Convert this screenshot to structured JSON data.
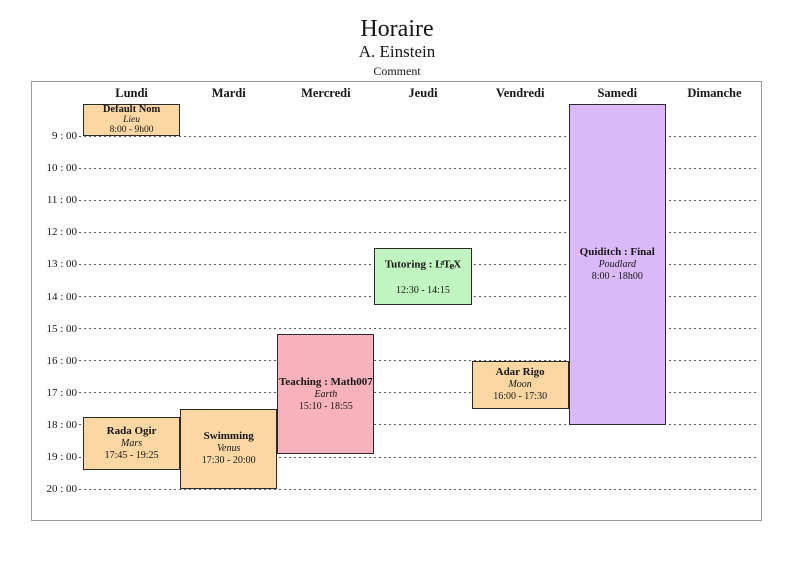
{
  "page": {
    "title": "Horaire",
    "author": "A. Einstein",
    "comment": "Comment"
  },
  "schedule": {
    "days": [
      "Lundi",
      "Mardi",
      "Mercredi",
      "Jeudi",
      "Vendredi",
      "Samedi",
      "Dimanche"
    ],
    "hour_labels": [
      "9 : 00",
      "10 : 00",
      "11 : 00",
      "12 : 00",
      "13 : 00",
      "14 : 00",
      "15 : 00",
      "16 : 00",
      "17 : 00",
      "18 : 00",
      "19 : 00",
      "20 : 00"
    ],
    "first_hour": 9,
    "last_hour": 20
  },
  "events": [
    {
      "title": "Default Nom",
      "location": "Lieu",
      "time": "8:00 - 9h00",
      "day": "Lundi",
      "day_index": 0,
      "start_hour": 8,
      "end_hour": 9,
      "color": "#fbd7a4"
    },
    {
      "title": "Rada Ogir",
      "location": "Mars",
      "time": "17:45 - 19:25",
      "day": "Lundi",
      "day_index": 0,
      "start_hour": 17.75,
      "end_hour": 19.42,
      "color": "#fbd7a4"
    },
    {
      "title": "Swimming",
      "location": "Venus",
      "time": "17:30 - 20:00",
      "day": "Mardi",
      "day_index": 1,
      "start_hour": 17.5,
      "end_hour": 20,
      "color": "#fbd7a4"
    },
    {
      "title": "Teaching : Math007",
      "location": "Earth",
      "time": "15:10 - 18:55",
      "day": "Mercredi",
      "day_index": 2,
      "start_hour": 15.17,
      "end_hour": 18.92,
      "color": "#f8b2bc"
    },
    {
      "title": "Tutoring : LaTeX",
      "latex_logo": true,
      "location": "",
      "time": "12:30 - 14:15",
      "day": "Jeudi",
      "day_index": 3,
      "start_hour": 12.5,
      "end_hour": 14.25,
      "color": "#c0f5c1"
    },
    {
      "title": "Adar Rigo",
      "location": "Moon",
      "time": "16:00 - 17:30",
      "day": "Vendredi",
      "day_index": 4,
      "start_hour": 16,
      "end_hour": 17.5,
      "color": "#fbd7a4"
    },
    {
      "title": "Quiditch : Final",
      "location": "Poudlard",
      "time": "8:00 - 18h00",
      "day": "Samedi",
      "day_index": 5,
      "start_hour": 8,
      "end_hour": 18,
      "color": "#dbb8f7"
    }
  ],
  "colors": {
    "frame_border": "#9a9a9a",
    "grid_dashes": "#5a5a5a",
    "event_border": "#2a2a2a",
    "event_peach": "#fbd7a4",
    "event_pink": "#f8b2bc",
    "event_green": "#c0f5c1",
    "event_purple": "#dbb8f7"
  },
  "chart_data": {
    "type": "table",
    "title": "Horaire",
    "subtitle": "A. Einstein",
    "comment": "Comment",
    "columns": [
      "Lundi",
      "Mardi",
      "Mercredi",
      "Jeudi",
      "Vendredi",
      "Samedi",
      "Dimanche"
    ],
    "y_axis": {
      "ticks": [
        "9 : 00",
        "10 : 00",
        "11 : 00",
        "12 : 00",
        "13 : 00",
        "14 : 00",
        "15 : 00",
        "16 : 00",
        "17 : 00",
        "18 : 00",
        "19 : 00",
        "20 : 00"
      ],
      "hour_range": [
        8,
        20
      ],
      "grid": "dashed"
    },
    "events": [
      {
        "day": "Lundi",
        "title": "Default Nom",
        "location": "Lieu",
        "time_range": "8:00 - 9h00"
      },
      {
        "day": "Lundi",
        "title": "Rada Ogir",
        "location": "Mars",
        "time_range": "17:45 - 19:25"
      },
      {
        "day": "Mardi",
        "title": "Swimming",
        "location": "Venus",
        "time_range": "17:30 - 20:00"
      },
      {
        "day": "Mercredi",
        "title": "Teaching : Math007",
        "location": "Earth",
        "time_range": "15:10 - 18:55"
      },
      {
        "day": "Jeudi",
        "title": "Tutoring : LaTeX",
        "location": "",
        "time_range": "12:30 - 14:15"
      },
      {
        "day": "Vendredi",
        "title": "Adar Rigo",
        "location": "Moon",
        "time_range": "16:00 - 17:30"
      },
      {
        "day": "Samedi",
        "title": "Quiditch : Final",
        "location": "Poudlard",
        "time_range": "8:00 - 18h00"
      }
    ]
  }
}
